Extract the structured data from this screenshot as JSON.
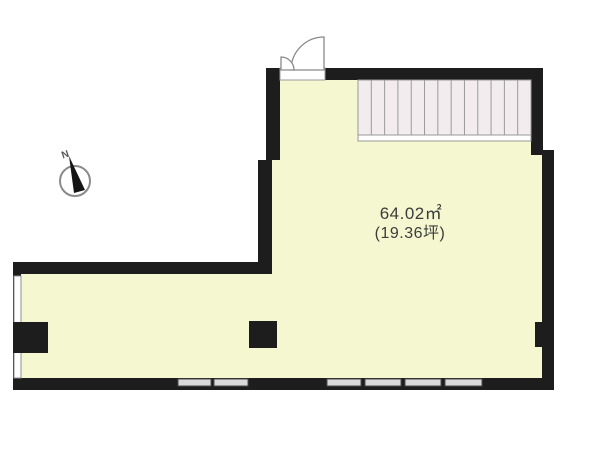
{
  "plan": {
    "area_m2": "64.02㎡",
    "area_tsubo": "(19.36坪)",
    "compass_label": "N",
    "colors": {
      "background": "#ffffff",
      "interior": "#f5f7d0",
      "stairs_fill": "#f3ecee",
      "wall": "#1d1d1d",
      "window_fill": "#d9d9d9",
      "window_stroke": "#4a4a4a",
      "line": "#8f8f8f"
    },
    "stairs": {
      "x": 358,
      "y": 80,
      "width": 173,
      "height": 55,
      "treads": 13,
      "strip_h": 6
    },
    "window_y": 379,
    "window_h": 7,
    "windows_bottom": [
      {
        "x": 178,
        "width": 33
      },
      {
        "x": 214,
        "width": 34
      },
      {
        "x": 327,
        "width": 34
      },
      {
        "x": 365,
        "width": 36
      },
      {
        "x": 405,
        "width": 36
      },
      {
        "x": 445,
        "width": 37
      }
    ],
    "left_window": {
      "x": 14,
      "y": 276,
      "width": 7,
      "height": 102
    },
    "pillars": [
      {
        "x": 13,
        "y": 322,
        "w": 35,
        "h": 31
      },
      {
        "x": 249,
        "y": 321,
        "w": 28,
        "h": 27
      },
      {
        "x": 535,
        "y": 322,
        "w": 19,
        "h": 25
      }
    ]
  }
}
